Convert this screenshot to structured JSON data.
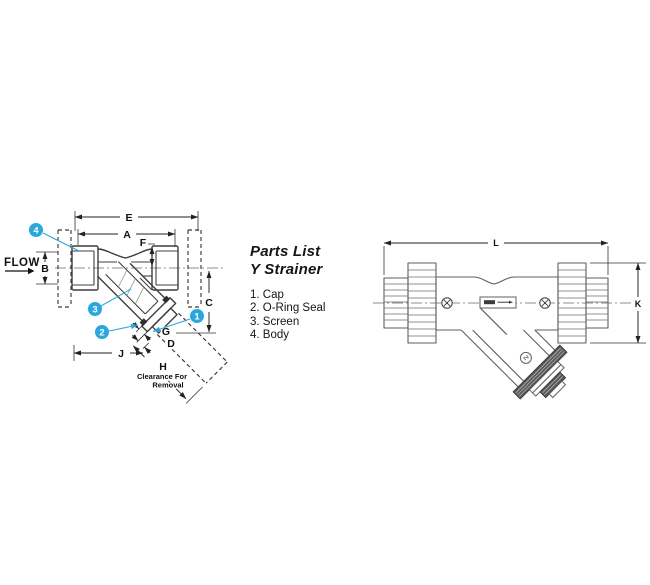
{
  "colors": {
    "background": "#ffffff",
    "drawing_line": "#3f3f3f",
    "drawing_line_right": "#5f5f5f",
    "dimension_line": "#222222",
    "callout_fill": "#2aa7dc",
    "callout_text": "#ffffff",
    "oring_mark": "#2f2f2f",
    "thread_band": "#565656"
  },
  "left_view": {
    "flow_label": "FLOW",
    "dims": {
      "E": "E",
      "A": "A",
      "F": "F",
      "B": "B",
      "C": "C",
      "G": "G",
      "D": "D",
      "J": "J",
      "H": "H"
    },
    "clearance_note_line1": "Clearance For",
    "clearance_note_line2": "Removal",
    "callouts": {
      "cap": "1",
      "oring": "2",
      "screen": "3",
      "body": "4"
    }
  },
  "parts_list": {
    "title_line1": "Parts List",
    "title_line2": "Y Strainer",
    "items": [
      "1. Cap",
      "2. O-Ring Seal",
      "3. Screen",
      "4. Body"
    ]
  },
  "right_view": {
    "dims": {
      "L": "L",
      "K": "K"
    }
  }
}
